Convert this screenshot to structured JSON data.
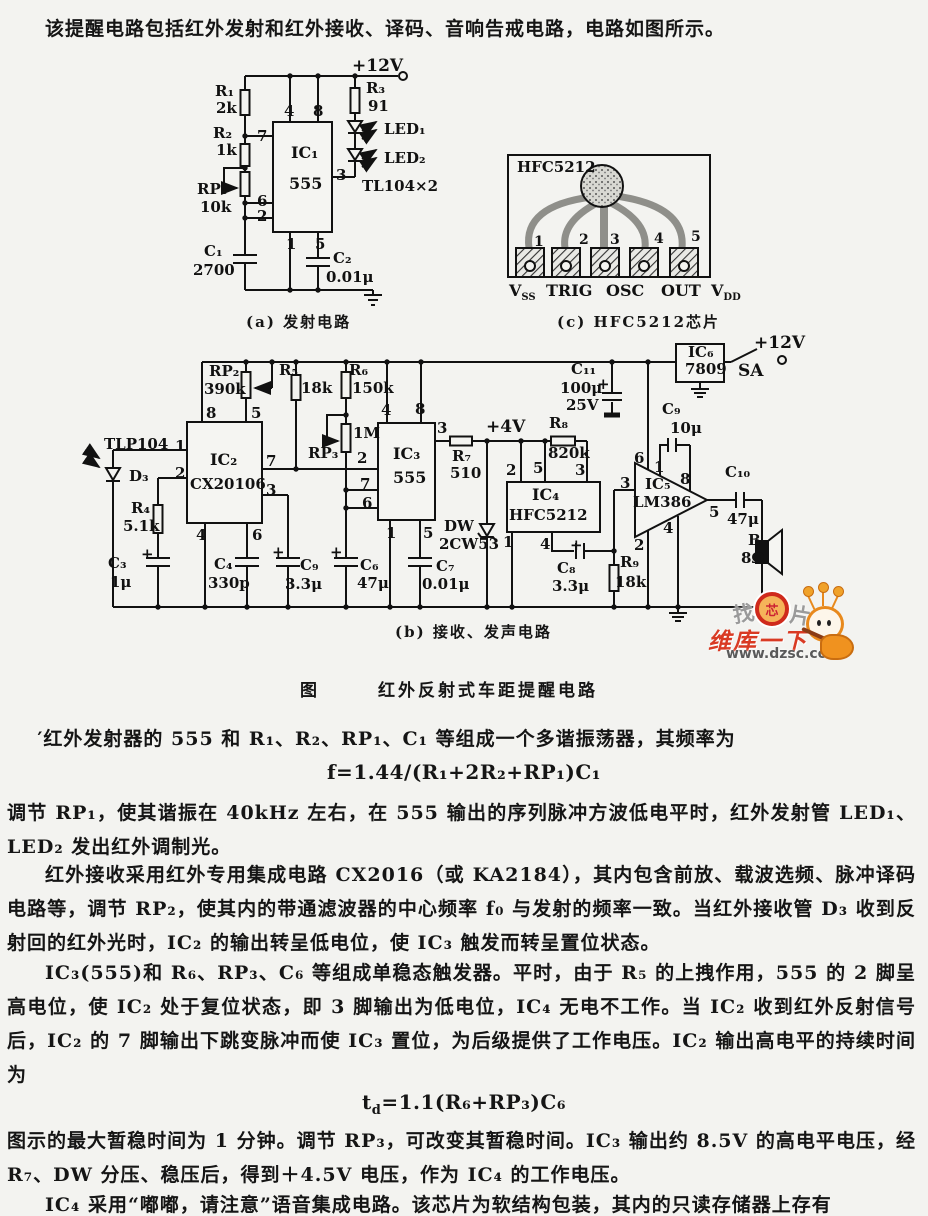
{
  "page": {
    "intro": "该提醒电路包括红外发射和红外接收、译码、音响告戒电路，电路如图所示。",
    "figure_label": "图",
    "figure_title": "红外反射式车距提醒电路",
    "captions": {
      "a": "(a) 发射电路",
      "b": "(b) 接收、发声电路",
      "c": "(c) HFC5212芯片"
    },
    "paragraphs": {
      "p1": "′红外发射器的 555 和 R₁、R₂、RP₁、C₁ 等组成一个多谐振荡器，其频率为",
      "f1": "f=1.44/(R₁+2R₂+RP₁)C₁",
      "p2": "调节 RP₁，使其谐振在 40kHz 左右，在 555 输出的序列脉冲方波低电平时，红外发射管 LED₁、LED₂ 发出红外调制光。",
      "p3": "红外接收采用红外专用集成电路 CX2016（或 KA2184），其内包含前放、载波选频、脉冲译码电路等，调节 RP₂，使其内的带通滤波器的中心频率 f₀ 与发射的频率一致。当红外接收管 D₃ 收到反射回的红外光时，IC₂ 的输出转呈低电位，使 IC₃ 触发而转呈置位状态。",
      "p4": "IC₃(555)和 R₆、RP₃、C₆ 等组成单稳态触发器。平时，由于 R₅ 的上拽作用，555 的 2 脚呈高电位，使 IC₂ 处于复位状态，即 3 脚输出为低电位，IC₄ 无电不工作。当 IC₂ 收到红外反射信号后，IC₂ 的 7 脚输出下跳变脉冲而使 IC₃ 置位，为后级提供了工作电压。IC₂ 输出高电平的持续时间为",
      "f2_pre": "t",
      "f2_sub": "d",
      "f2_rest": "=1.1(R₆+RP₃)C₆",
      "p5": "图示的最大暂稳时间为 1 分钟。调节 RP₃，可改变其暂稳时间。IC₃ 输出约 8.5V 的高电平电压，经 R₇、DW 分压、稳压后，得到＋4.5V 电压，作为 IC₄ 的工作电压。",
      "p6": "IC₄ 采用“嘟嘟，请注意”语音集成电路。该芯片为软结构包装，其内的只读存储器上存有"
    }
  },
  "watermark": {
    "find": "找",
    "chip": "芯",
    "pian": "片",
    "brand": "维库一下",
    "url": "www.dzsc.com",
    "red": "#d93a23",
    "orange": "#f0921f"
  },
  "diagram": {
    "labels": [
      {
        "t": "+12V",
        "x": 352,
        "y": 58,
        "fs": 17
      },
      {
        "t": "R₁",
        "x": 215,
        "y": 84
      },
      {
        "t": "2k",
        "x": 216,
        "y": 101
      },
      {
        "t": "R₂",
        "x": 213,
        "y": 126
      },
      {
        "t": "1k",
        "x": 216,
        "y": 143
      },
      {
        "t": "RP₁",
        "x": 197,
        "y": 182
      },
      {
        "t": "10k",
        "x": 200,
        "y": 200
      },
      {
        "t": "C₁",
        "x": 204,
        "y": 244
      },
      {
        "t": "2700",
        "x": 193,
        "y": 263
      },
      {
        "t": "4",
        "x": 284,
        "y": 104
      },
      {
        "t": "8",
        "x": 313,
        "y": 104
      },
      {
        "t": "7",
        "x": 257,
        "y": 129
      },
      {
        "t": "6",
        "x": 257,
        "y": 194
      },
      {
        "t": "2",
        "x": 257,
        "y": 209
      },
      {
        "t": "3",
        "x": 336,
        "y": 168
      },
      {
        "t": "1",
        "x": 286,
        "y": 237
      },
      {
        "t": "5",
        "x": 315,
        "y": 237
      },
      {
        "t": "IC₁",
        "x": 291,
        "y": 145,
        "fs": 16
      },
      {
        "t": "555",
        "x": 289,
        "y": 176,
        "fs": 16
      },
      {
        "t": "R₃",
        "x": 366,
        "y": 81
      },
      {
        "t": "91",
        "x": 368,
        "y": 99
      },
      {
        "t": "LED₁",
        "x": 384,
        "y": 122
      },
      {
        "t": "LED₂",
        "x": 384,
        "y": 151
      },
      {
        "t": "TL104×2",
        "x": 362,
        "y": 179
      },
      {
        "t": "C₂",
        "x": 333,
        "y": 251
      },
      {
        "t": "0.01μ",
        "x": 326,
        "y": 270
      },
      {
        "t": "HFC5212",
        "x": 517,
        "y": 160
      },
      {
        "t": "1",
        "x": 534,
        "y": 235,
        "fs": 14
      },
      {
        "t": "2",
        "x": 579,
        "y": 233,
        "fs": 14
      },
      {
        "t": "3",
        "x": 610,
        "y": 233,
        "fs": 14
      },
      {
        "t": "4",
        "x": 654,
        "y": 232,
        "fs": 14
      },
      {
        "t": "5",
        "x": 691,
        "y": 230,
        "fs": 14
      },
      {
        "t": "V",
        "x": 509,
        "y": 283,
        "fs": 16,
        "sub": "SS"
      },
      {
        "t": "TRIG",
        "x": 546,
        "y": 283,
        "fs": 16
      },
      {
        "t": "OSC",
        "x": 606,
        "y": 283,
        "fs": 16
      },
      {
        "t": "OUT",
        "x": 661,
        "y": 283,
        "fs": 16
      },
      {
        "t": "V",
        "x": 711,
        "y": 283,
        "fs": 16,
        "sub": "DD"
      },
      {
        "t": "RP₂",
        "x": 209,
        "y": 364
      },
      {
        "t": "390k",
        "x": 204,
        "y": 382
      },
      {
        "t": "R₅",
        "x": 279,
        "y": 363
      },
      {
        "t": "18k",
        "x": 301,
        "y": 381
      },
      {
        "t": "R₆",
        "x": 349,
        "y": 363
      },
      {
        "t": "150k",
        "x": 352,
        "y": 381
      },
      {
        "t": "1M",
        "x": 353,
        "y": 426
      },
      {
        "t": "RP₃",
        "x": 308,
        "y": 446
      },
      {
        "t": "TLP104",
        "x": 104,
        "y": 437
      },
      {
        "t": "1",
        "x": 175,
        "y": 439
      },
      {
        "t": "2",
        "x": 175,
        "y": 466
      },
      {
        "t": "D₃",
        "x": 129,
        "y": 469
      },
      {
        "t": "R₄",
        "x": 131,
        "y": 501
      },
      {
        "t": "5.1k",
        "x": 123,
        "y": 519
      },
      {
        "t": "+",
        "x": 141,
        "y": 547
      },
      {
        "t": "C₃",
        "x": 108,
        "y": 556
      },
      {
        "t": "1μ",
        "x": 110,
        "y": 575
      },
      {
        "t": "IC₂",
        "x": 210,
        "y": 452,
        "fs": 16
      },
      {
        "t": "CX20106",
        "x": 190,
        "y": 477,
        "fs": 15
      },
      {
        "t": "8",
        "x": 206,
        "y": 406
      },
      {
        "t": "5",
        "x": 251,
        "y": 406
      },
      {
        "t": "7",
        "x": 266,
        "y": 454
      },
      {
        "t": "3",
        "x": 266,
        "y": 483
      },
      {
        "t": "4",
        "x": 196,
        "y": 528
      },
      {
        "t": "6",
        "x": 252,
        "y": 528
      },
      {
        "t": "C₄",
        "x": 214,
        "y": 557
      },
      {
        "t": "330p",
        "x": 208,
        "y": 576
      },
      {
        "t": "+",
        "x": 272,
        "y": 545
      },
      {
        "t": "C₉",
        "x": 300,
        "y": 558
      },
      {
        "t": "3.3μ",
        "x": 285,
        "y": 577
      },
      {
        "t": "+",
        "x": 330,
        "y": 545
      },
      {
        "t": "C₆",
        "x": 360,
        "y": 558
      },
      {
        "t": "47μ",
        "x": 357,
        "y": 576
      },
      {
        "t": "IC₃",
        "x": 393,
        "y": 446,
        "fs": 16
      },
      {
        "t": "555",
        "x": 393,
        "y": 470,
        "fs": 16
      },
      {
        "t": "4",
        "x": 381,
        "y": 403
      },
      {
        "t": "8",
        "x": 415,
        "y": 402
      },
      {
        "t": "2",
        "x": 357,
        "y": 451
      },
      {
        "t": "7",
        "x": 360,
        "y": 477
      },
      {
        "t": "6",
        "x": 362,
        "y": 496
      },
      {
        "t": "3",
        "x": 437,
        "y": 421
      },
      {
        "t": "1",
        "x": 386,
        "y": 526
      },
      {
        "t": "5",
        "x": 423,
        "y": 526
      },
      {
        "t": "R₇",
        "x": 452,
        "y": 449
      },
      {
        "t": "510",
        "x": 450,
        "y": 466
      },
      {
        "t": "+4V",
        "x": 486,
        "y": 419,
        "fs": 17
      },
      {
        "t": "DW",
        "x": 444,
        "y": 519
      },
      {
        "t": "2CW53",
        "x": 439,
        "y": 537
      },
      {
        "t": "C₇",
        "x": 436,
        "y": 559
      },
      {
        "t": "0.01μ",
        "x": 422,
        "y": 577
      },
      {
        "t": "C₁₁",
        "x": 571,
        "y": 362
      },
      {
        "t": "100μ",
        "x": 560,
        "y": 381
      },
      {
        "t": "25V",
        "x": 566,
        "y": 398
      },
      {
        "t": "+",
        "x": 597,
        "y": 377
      },
      {
        "t": "R₈",
        "x": 549,
        "y": 416
      },
      {
        "t": "820k",
        "x": 548,
        "y": 446
      },
      {
        "t": "IC₄",
        "x": 532,
        "y": 487,
        "fs": 16
      },
      {
        "t": "HFC5212",
        "x": 509,
        "y": 508,
        "fs": 15
      },
      {
        "t": "2",
        "x": 506,
        "y": 463
      },
      {
        "t": "5",
        "x": 533,
        "y": 461
      },
      {
        "t": "3",
        "x": 575,
        "y": 463
      },
      {
        "t": "1",
        "x": 503,
        "y": 535
      },
      {
        "t": "4",
        "x": 540,
        "y": 537
      },
      {
        "t": "+",
        "x": 570,
        "y": 538
      },
      {
        "t": "C₈",
        "x": 557,
        "y": 561
      },
      {
        "t": "3.3μ",
        "x": 552,
        "y": 579
      },
      {
        "t": "R₉",
        "x": 620,
        "y": 555
      },
      {
        "t": "18k",
        "x": 615,
        "y": 575
      },
      {
        "t": "IC₅",
        "x": 645,
        "y": 477,
        "fs": 15
      },
      {
        "t": "LM386",
        "x": 633,
        "y": 495,
        "fs": 15
      },
      {
        "t": "6",
        "x": 634,
        "y": 451
      },
      {
        "t": "1",
        "x": 654,
        "y": 460
      },
      {
        "t": "8",
        "x": 680,
        "y": 472
      },
      {
        "t": "3",
        "x": 620,
        "y": 476
      },
      {
        "t": "2",
        "x": 634,
        "y": 538
      },
      {
        "t": "4",
        "x": 663,
        "y": 521
      },
      {
        "t": "5",
        "x": 709,
        "y": 505
      },
      {
        "t": "C₉",
        "x": 662,
        "y": 402
      },
      {
        "t": "10μ",
        "x": 670,
        "y": 421
      },
      {
        "t": "IC₆",
        "x": 688,
        "y": 345,
        "fs": 15
      },
      {
        "t": "7809",
        "x": 685,
        "y": 362,
        "fs": 15
      },
      {
        "t": "SA",
        "x": 738,
        "y": 363,
        "fs": 17
      },
      {
        "t": "+12V",
        "x": 754,
        "y": 335,
        "fs": 17
      },
      {
        "t": "C₁₀",
        "x": 725,
        "y": 465
      },
      {
        "t": "47μ",
        "x": 727,
        "y": 512
      },
      {
        "t": "B",
        "x": 748,
        "y": 533
      },
      {
        "t": "8Ω",
        "x": 741,
        "y": 551
      }
    ]
  }
}
